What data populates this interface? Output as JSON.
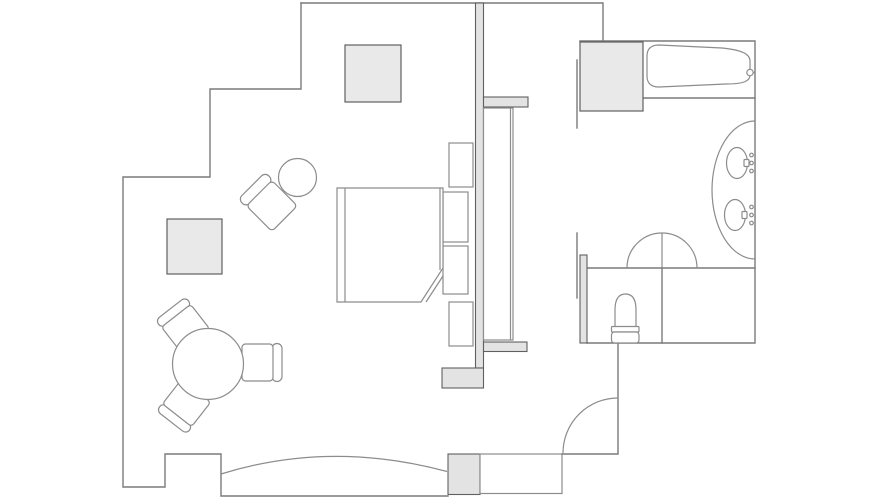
{
  "canvas": {
    "width": 890,
    "height": 500,
    "background": "#ffffff"
  },
  "colors": {
    "background": "#ffffff",
    "wall_line": "#7a7a7a",
    "wall_fill": "#e3e3e3",
    "line_thin": "#8c8c8c",
    "cabinet_fill": "#e9e9e9",
    "cabinet_line": "#606060",
    "furniture_fill": "#ffffff"
  },
  "plan": {
    "type": "guestroom-floor-plan",
    "areas": [
      "sleeping-living-area",
      "wardrobe-corridor",
      "bathroom",
      "toilet-compartment",
      "entry-vestibule"
    ],
    "fixture_counts": {
      "double_bed": 1,
      "nightstands": 2,
      "headboard_cabinets": 2,
      "gray_cabinet_squares": 3,
      "armchair": 1,
      "round_side_table": 1,
      "round_dining_table": 1,
      "dining_chairs": 3,
      "wardrobe_closet": 1,
      "bathtub": 1,
      "vanity_sinks": 2,
      "toilet": 1,
      "swing_doors": 2,
      "pocket_door": 1,
      "bow_window": 1
    }
  }
}
